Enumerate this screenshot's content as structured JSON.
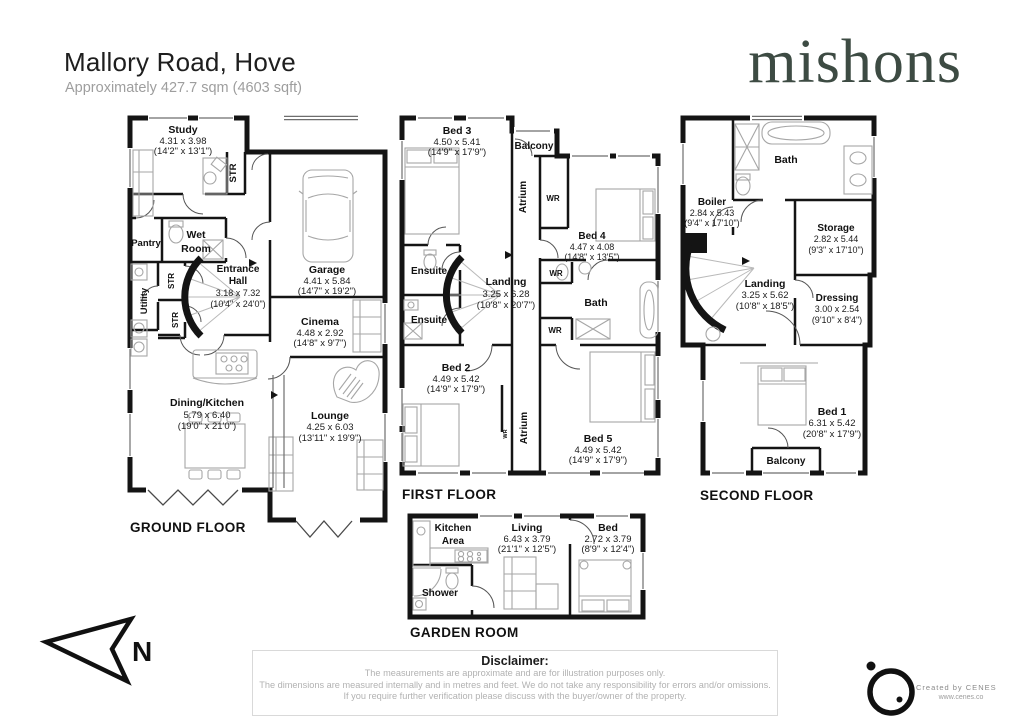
{
  "header": {
    "title": "Mallory Road, Hove",
    "subtitle": "Approximately 427.7 sqm (4603 sqft)",
    "brand": "mishons"
  },
  "compass": {
    "label": "N"
  },
  "floors": {
    "ground": {
      "label": "GROUND FLOOR",
      "rooms": {
        "study": {
          "name": "Study",
          "m": "4.31 x 3.98",
          "ft": "(14'2\" x 13'1\")"
        },
        "str_study": {
          "name": "STR"
        },
        "str1": {
          "name": "STR"
        },
        "str2": {
          "name": "STR"
        },
        "pantry": {
          "name": "Pantry"
        },
        "wet_room": {
          "n1": "Wet",
          "n2": "Room"
        },
        "entrance_hall": {
          "n1": "Entrance",
          "n2": "Hall",
          "m": "3.18 x 7.32",
          "ft": "(10'4\" x 24'0\")"
        },
        "utility": {
          "name": "Utility"
        },
        "garage": {
          "name": "Garage",
          "m": "4.41 x 5.84",
          "ft": "(14'7\" x 19'2\")"
        },
        "cinema": {
          "name": "Cinema",
          "m": "4.48 x 2.92",
          "ft": "(14'8\" x 9'7\")"
        },
        "dining_kitchen": {
          "name": "Dining/Kitchen",
          "m": "5.79 x 6.40",
          "ft": "(19'0\" x 21'0\")"
        },
        "lounge": {
          "name": "Lounge",
          "m": "4.25 x 6.03",
          "ft": "(13'11\" x 19'9\")"
        }
      }
    },
    "first": {
      "label": "FIRST FLOOR",
      "rooms": {
        "bed3": {
          "name": "Bed 3",
          "m": "4.50 x 5.41",
          "ft": "(14'9\" x 17'9\")"
        },
        "balcony": {
          "name": "Balcony"
        },
        "atrium_top": {
          "name": "Atrium"
        },
        "atrium_bottom": {
          "name": "Atrium"
        },
        "wr_bed4": {
          "name": "WR"
        },
        "bed4": {
          "name": "Bed 4",
          "m": "4.47 x 4.08",
          "ft": "(14'8\" x 13'5\")"
        },
        "ensuite1": {
          "name": "Ensuite"
        },
        "ensuite2": {
          "name": "Ensuite"
        },
        "landing": {
          "name": "Landing",
          "m": "3.25 x 6.28",
          "ft": "(10'8\" x 20'7\")"
        },
        "bath": {
          "name": "Bath"
        },
        "wr_bath1": {
          "name": "WR"
        },
        "wr_bath2": {
          "name": "WR"
        },
        "wr_small": {
          "name": "WR"
        },
        "bed2": {
          "name": "Bed 2",
          "m": "4.49 x 5.42",
          "ft": "(14'9\" x 17'9\")"
        },
        "bed5": {
          "name": "Bed 5",
          "m": "4.49 x 5.42",
          "ft": "(14'9\" x 17'9\")"
        }
      }
    },
    "second": {
      "label": "SECOND FLOOR",
      "rooms": {
        "bath": {
          "name": "Bath"
        },
        "boiler": {
          "name": "Boiler",
          "m": "2.84 x 5.43",
          "ft": "(9'4\" x 17'10\")"
        },
        "storage": {
          "name": "Storage",
          "m": "2.82 x 5.44",
          "ft": "(9'3\" x 17'10\")"
        },
        "landing": {
          "name": "Landing",
          "m": "3.25 x 5.62",
          "ft": "(10'8\" x 18'5\")"
        },
        "dressing": {
          "name": "Dressing",
          "m": "3.00 x 2.54",
          "ft": "(9'10\" x 8'4\")"
        },
        "bed1": {
          "name": "Bed 1",
          "m": "6.31 x 5.42",
          "ft": "(20'8\" x 17'9\")"
        },
        "balcony": {
          "name": "Balcony"
        }
      }
    },
    "garden": {
      "label": "GARDEN ROOM",
      "rooms": {
        "kitchen_area": {
          "n1": "Kitchen",
          "n2": "Area"
        },
        "living": {
          "name": "Living",
          "m": "6.43 x 3.79",
          "ft": "(21'1\" x 12'5\")"
        },
        "bed": {
          "name": "Bed",
          "m": "2.72 x 3.79",
          "ft": "(8'9\" x 12'4\")"
        },
        "shower": {
          "name": "Shower"
        }
      }
    }
  },
  "disclaimer": {
    "title": "Disclaimer:",
    "line1": "The measurements are approximate and are for illustration purposes only.",
    "line2": "The dimensions are measured internally and in metres and feet. We do not take any responsibility for errors and/or omissions.",
    "line3": "If you require further verification please discuss with the buyer/owner of the property."
  },
  "credit": {
    "text": "Created by CENES",
    "url": "www.cenes.co"
  },
  "colors": {
    "wall": "#141414",
    "brand": "#3d4b43",
    "furniture": "#a6a6a6",
    "muted_text": "#b2b2b2"
  }
}
